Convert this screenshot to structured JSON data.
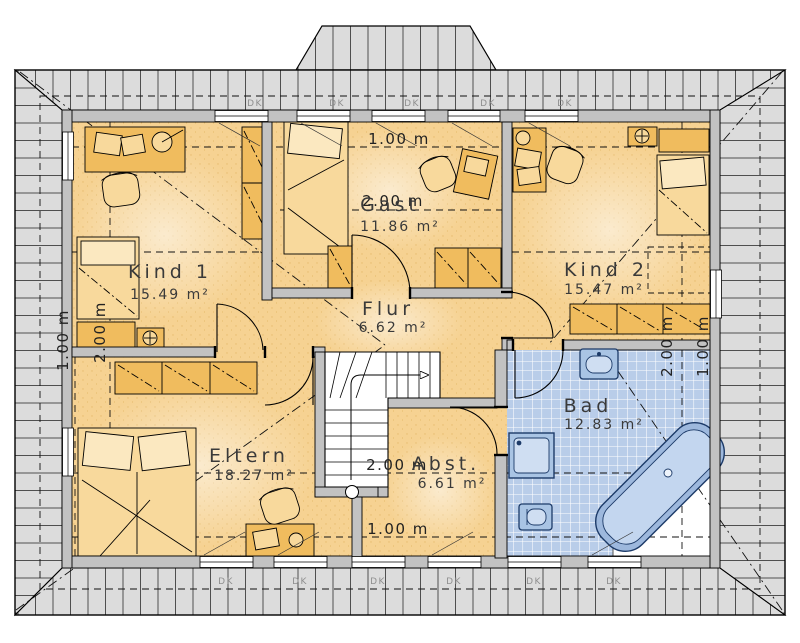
{
  "plan": {
    "type": "floor-plan",
    "rooms": [
      {
        "name": "Kind 1",
        "area": "15.49 m²"
      },
      {
        "name": "Gast",
        "area": "11.86 m²"
      },
      {
        "name": "Kind 2",
        "area": "15.47 m²"
      },
      {
        "name": "Flur",
        "area": "6.62 m²"
      },
      {
        "name": "Eltern",
        "area": "18.27 m²"
      },
      {
        "name": "Abst.",
        "area": "6.61 m²"
      },
      {
        "name": "Bad",
        "area": "12.83 m²"
      }
    ],
    "dimension_labels": {
      "top_1m": "1.00 m",
      "top_2m": "2.00 m",
      "bottom_2m": "2.00 m",
      "bottom_1m": "1.00 m",
      "left_1m": "1.00 m",
      "left_2m": "2.00 m",
      "right_2m": "2.00 m",
      "right_1m": "1.00 m"
    },
    "window_label": "DK",
    "colors": {
      "floor": "#f6d292",
      "roof_band": "#dcdcdc",
      "wall": "#c2c2c2",
      "tile": "#b9cde9",
      "furniture": "#f0bc5e",
      "fixture": "#cfdef2",
      "fixture_stroke": "#1c3a68"
    }
  }
}
